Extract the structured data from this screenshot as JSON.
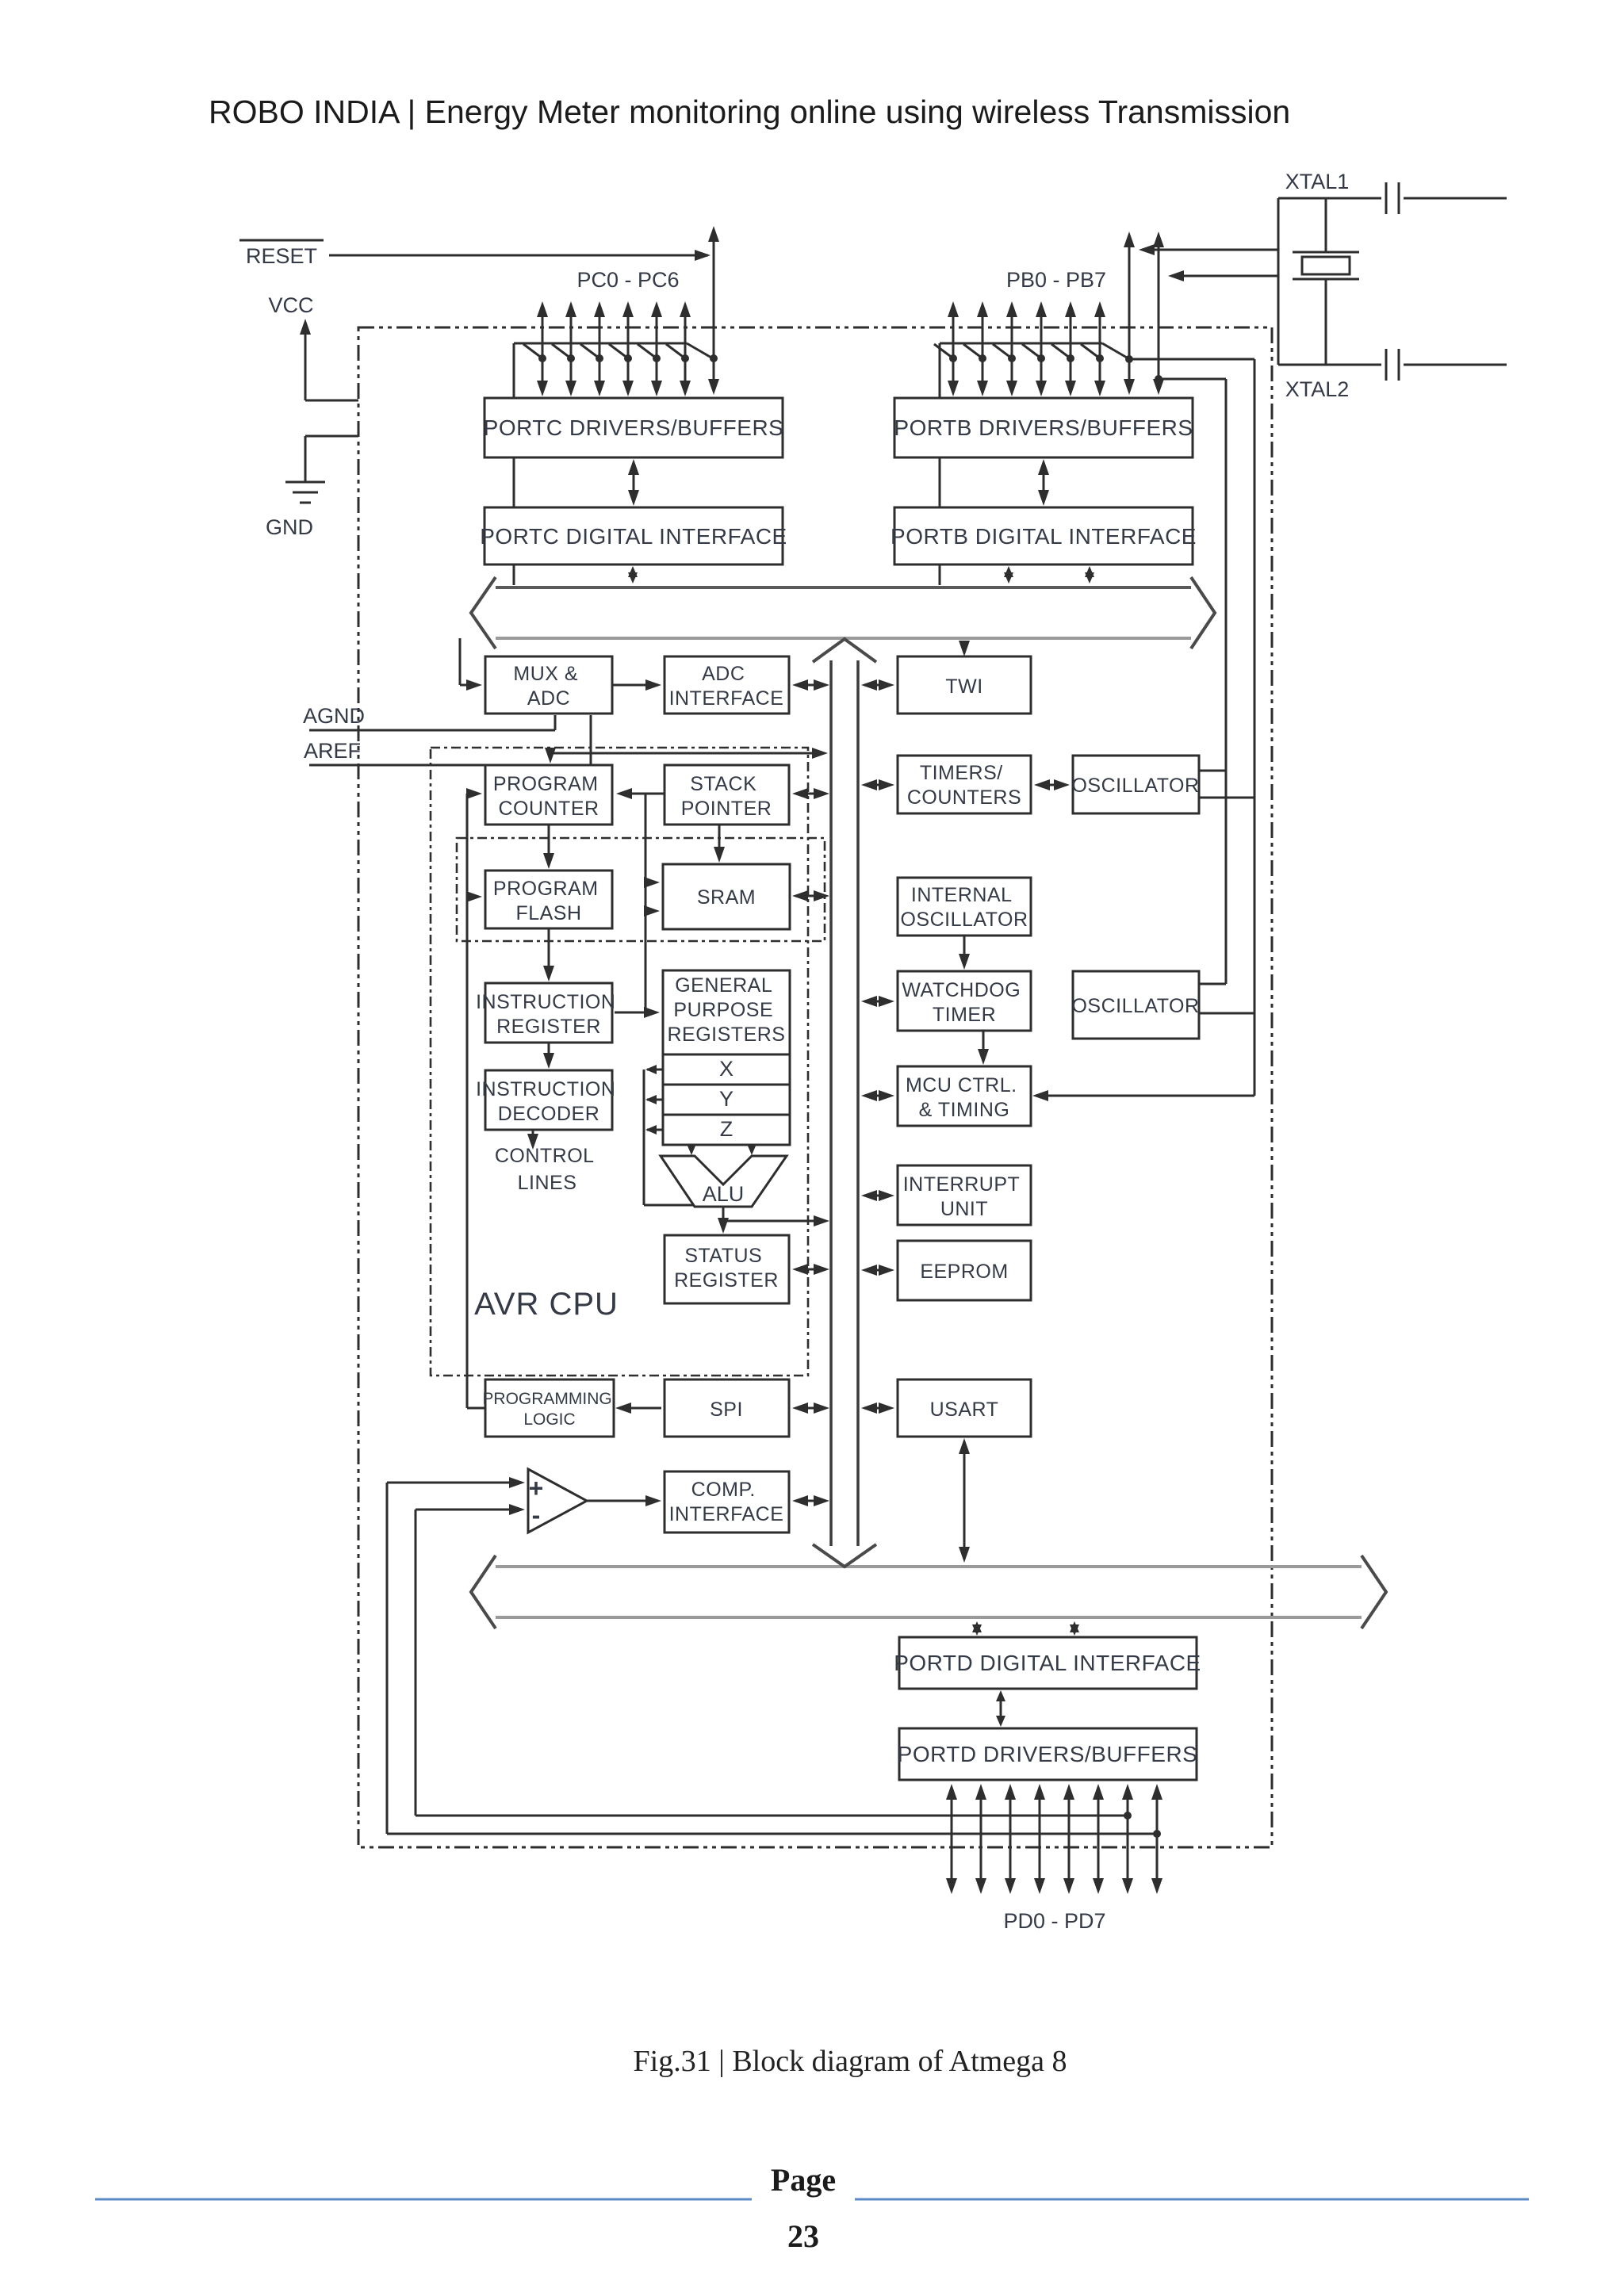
{
  "header": {
    "title": "ROBO INDIA | Energy Meter monitoring online using wireless Transmission"
  },
  "diagram": {
    "signals": {
      "reset": "RESET",
      "vcc": "VCC",
      "gnd": "GND",
      "agnd": "AGND",
      "aref": "AREF",
      "pc_range": "PC0 - PC6",
      "pb_range": "PB0 - PB7",
      "pd_range": "PD0 - PD7",
      "xtal1": "XTAL1",
      "xtal2": "XTAL2"
    },
    "blocks": {
      "portc_drivers": "PORTC DRIVERS/BUFFERS",
      "portc_digital": "PORTC DIGITAL INTERFACE",
      "portb_drivers": "PORTB DRIVERS/BUFFERS",
      "portb_digital": "PORTB DIGITAL INTERFACE",
      "mux_adc": [
        "MUX &",
        "ADC"
      ],
      "adc_interface": [
        "ADC",
        "INTERFACE"
      ],
      "twi": "TWI",
      "program_counter": [
        "PROGRAM",
        "COUNTER"
      ],
      "stack_pointer": [
        "STACK",
        "POINTER"
      ],
      "timers_counters": [
        "TIMERS/",
        "COUNTERS"
      ],
      "oscillator_top": "OSCILLATOR",
      "program_flash": [
        "PROGRAM",
        "FLASH"
      ],
      "sram": "SRAM",
      "internal_oscillator": [
        "INTERNAL",
        "OSCILLATOR"
      ],
      "instruction_register": [
        "INSTRUCTION",
        "REGISTER"
      ],
      "general_purpose_registers": [
        "GENERAL",
        "PURPOSE",
        "REGISTERS"
      ],
      "watchdog_timer": [
        "WATCHDOG",
        "TIMER"
      ],
      "oscillator_bottom": "OSCILLATOR",
      "instruction_decoder": [
        "INSTRUCTION",
        "DECODER"
      ],
      "reg_x": "X",
      "reg_y": "Y",
      "reg_z": "Z",
      "mcu_ctrl_timing": [
        "MCU CTRL.",
        "& TIMING"
      ],
      "control_lines": [
        "CONTROL",
        "LINES"
      ],
      "alu": "ALU",
      "interrupt_unit": [
        "INTERRUPT",
        "UNIT"
      ],
      "avr_cpu": "AVR CPU",
      "status_register": [
        "STATUS",
        "REGISTER"
      ],
      "eeprom": "EEPROM",
      "programming_logic": [
        "PROGRAMMING",
        "LOGIC"
      ],
      "spi": "SPI",
      "usart": "USART",
      "comp_interface": [
        "COMP.",
        "INTERFACE"
      ],
      "portd_digital": "PORTD DIGITAL INTERFACE",
      "portd_drivers": "PORTD DRIVERS/BUFFERS",
      "comparator_plus": "+",
      "comparator_minus": "-"
    }
  },
  "caption": {
    "text": "Fig.31 | Block diagram of Atmega 8"
  },
  "footer": {
    "label": "Page",
    "number": "23",
    "line_color": "#5b8ac5"
  }
}
